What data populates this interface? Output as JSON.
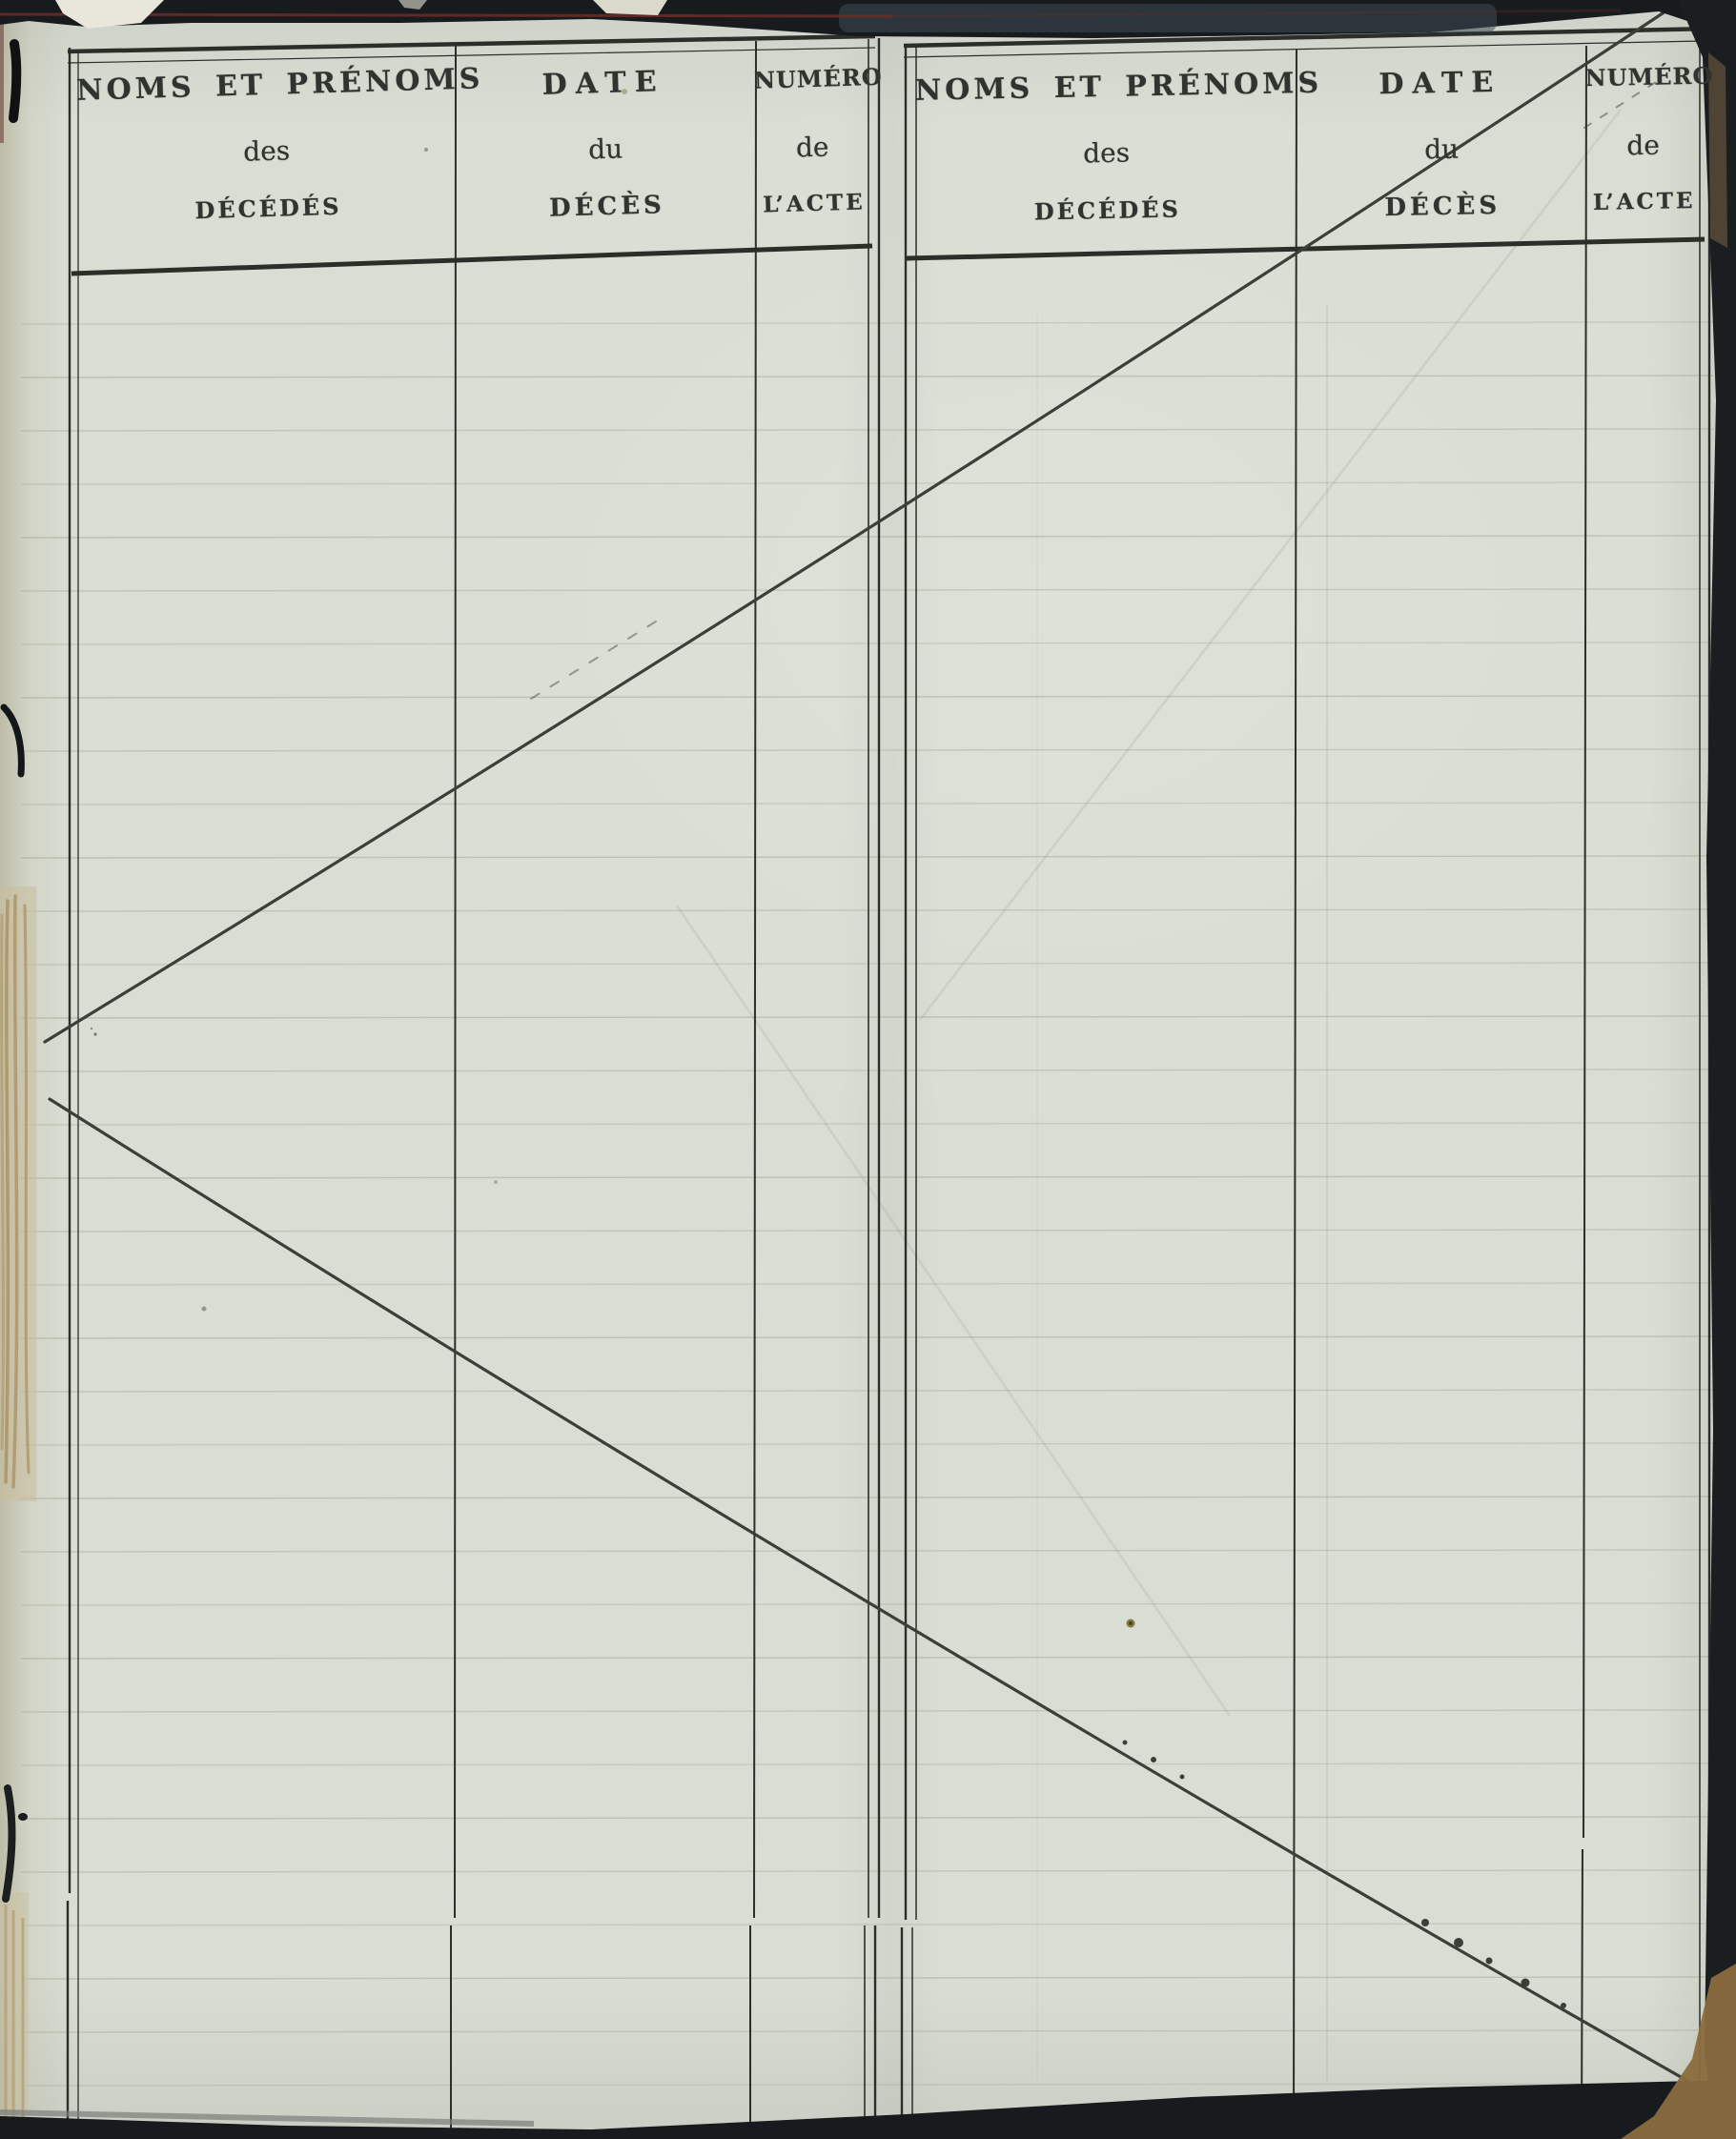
{
  "document": {
    "kind": "scanned death register page (table of deaths, crossed out / no entries)",
    "tables": [
      {
        "side": "left",
        "columns": [
          {
            "title": "NOMS ET PRÉNOMS",
            "subtitle": "des",
            "subtitle2": "DÉCÉDÉS"
          },
          {
            "title": "DATE",
            "subtitle": "du",
            "subtitle2": "DÉCÈS"
          },
          {
            "title": "NUMÉRO",
            "subtitle": "de",
            "subtitle2": "L’ACTE"
          }
        ]
      },
      {
        "side": "right",
        "columns": [
          {
            "title": "NOMS ET PRÉNOMS",
            "subtitle": "des",
            "subtitle2": "DÉCÉDÉS"
          },
          {
            "title": "DATE",
            "subtitle": "du",
            "subtitle2": "DÉCÈS"
          },
          {
            "title": "NUMÉRO",
            "subtitle": "de",
            "subtitle2": "L’ACTE"
          }
        ]
      }
    ]
  },
  "colors": {
    "paper": "#d9ded4",
    "cover": "#171b1e",
    "table-line": "#2b2f2a",
    "ruled": "#a9ae9f",
    "diagonal": "#3a3f3a",
    "ink": "#30332f",
    "maroon": "#6e2c28",
    "thread": "#ab9265",
    "tan": "#8a6c3e",
    "steel": "#3e4a54"
  }
}
